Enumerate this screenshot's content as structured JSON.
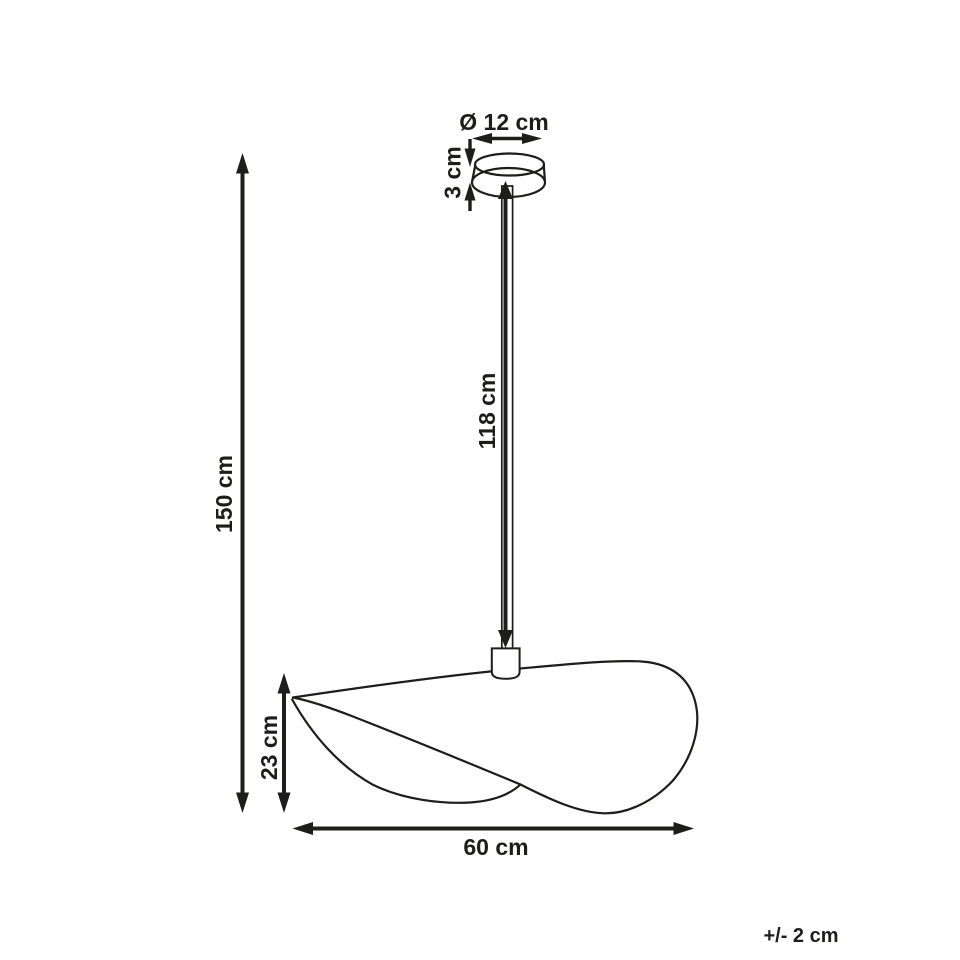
{
  "page": {
    "background_color": "#ffffff",
    "line_color": "#1d1d1b"
  },
  "labels": {
    "canopy_diameter": "Ø 12 cm",
    "canopy_height": "3 cm",
    "cord_length": "118 cm",
    "total_height": "150 cm",
    "shade_height": "23 cm",
    "shade_width": "60 cm",
    "tolerance": "+/- 2 cm"
  }
}
